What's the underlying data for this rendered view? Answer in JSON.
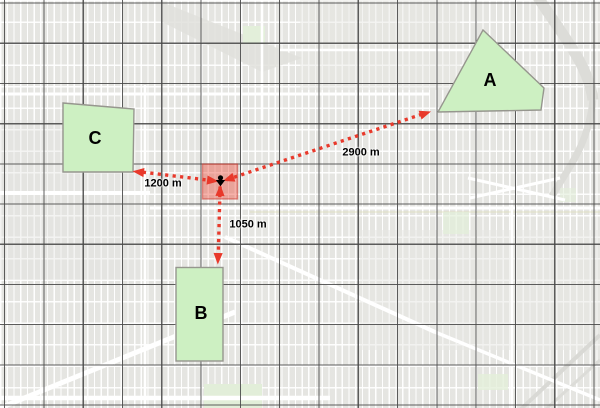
{
  "map": {
    "zones": [
      {
        "id": "A",
        "label": "A"
      },
      {
        "id": "B",
        "label": "B"
      },
      {
        "id": "C",
        "label": "C"
      }
    ],
    "measurements": [
      {
        "to": "A",
        "label": "2900 m"
      },
      {
        "to": "C",
        "label": "1200 m"
      },
      {
        "to": "B",
        "label": "1050 m"
      }
    ],
    "colors": {
      "map_base": "#ecece9",
      "street": "#ffffff",
      "grid_line": "#484848",
      "zone_fill": "#cdf0c2",
      "zone_outline": "#96968e",
      "arrow_red": "#e8392b",
      "incident_fill": "rgba(237,72,56,0.42)",
      "incident_stroke": "rgba(200,45,38,0.5)",
      "marker": "#000000"
    }
  }
}
